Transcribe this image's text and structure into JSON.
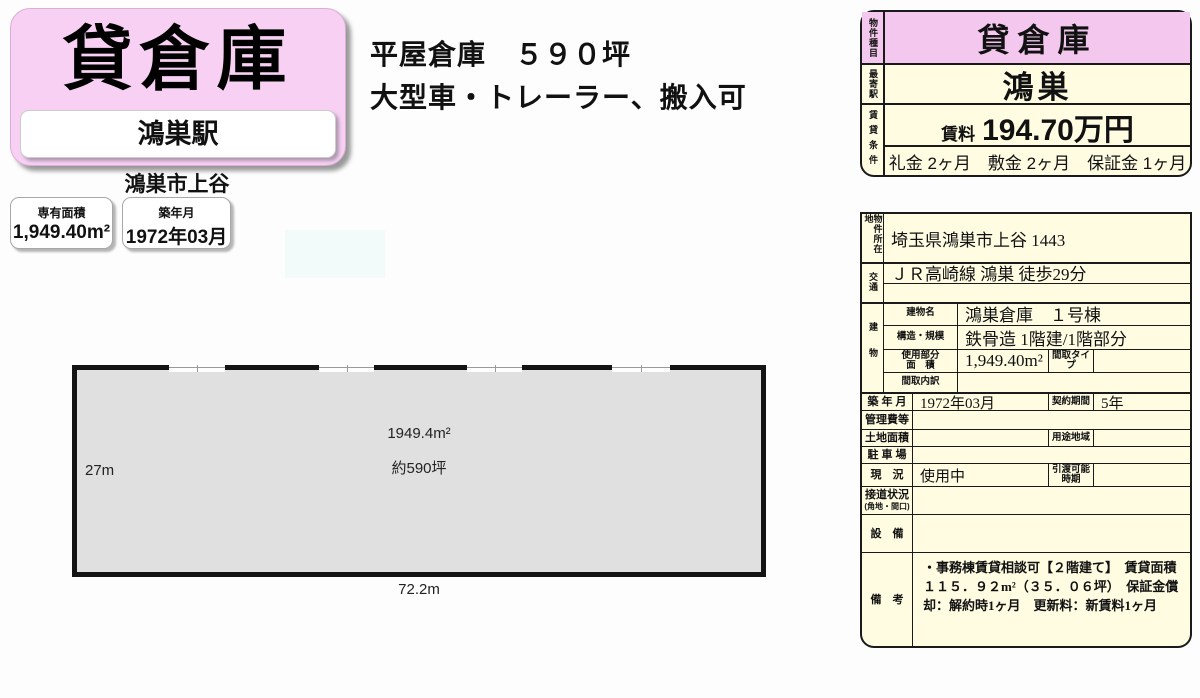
{
  "banner": {
    "title": "貸倉庫",
    "station": "鴻巣駅",
    "city": "鴻巣市上谷",
    "pink": "#f7d0f3"
  },
  "info_boxes": {
    "area": {
      "label": "専有面積",
      "value": "1,949.40m²"
    },
    "built": {
      "label": "築年月",
      "value": "1972年03月"
    }
  },
  "headline": {
    "line1": "平屋倉庫　５９０坪",
    "line2": "大型車・トレーラー、搬入可"
  },
  "floorplan": {
    "height_label": "27m",
    "width_label": "72.2m",
    "area_m2": "1949.4m²",
    "area_tsubo": "約590坪",
    "fill_color": "#e0e0e0"
  },
  "summary_table": {
    "pink": "#f4c8ee",
    "yellow": "#fffce2",
    "type": {
      "label": "物件種目",
      "value": "貸倉庫"
    },
    "station": {
      "label": "最寄駅",
      "value": "鴻巣"
    },
    "terms": {
      "label": "賃貸条件",
      "rent_label": "賃料",
      "rent": "194.70万円",
      "fees": "礼金 2ヶ月　敷金 2ヶ月　保証金 1ヶ月"
    }
  },
  "detail_table": {
    "location": {
      "label": "物件所在地",
      "value": "埼玉県鴻巣市上谷 1443"
    },
    "transport": {
      "label": "交通",
      "line1": "ＪＲ高崎線 鴻巣 徒歩29分",
      "line2": ""
    },
    "building": {
      "label": "建物",
      "name_label": "建物名",
      "name": "鴻巣倉庫　１号棟",
      "structure_label": "構造・規模",
      "structure": "鉄骨造 1階建/1階部分",
      "area_label_line1": "使用部分",
      "area_label_line2": "面　積",
      "area": "1,949.40m²",
      "plan_type_label": "間取タイプ",
      "plan_type": "",
      "plan_detail_label": "間取内訳",
      "plan_detail": ""
    },
    "built": {
      "label": "築 年 月",
      "value": "1972年03月"
    },
    "contract": {
      "label": "契約期間",
      "value": "5年"
    },
    "management_fee": {
      "label": "管理費等",
      "value": ""
    },
    "land_area": {
      "label": "土地面積",
      "value": ""
    },
    "zoning": {
      "label": "用途地域",
      "value": ""
    },
    "parking": {
      "label": "駐 車 場",
      "value": ""
    },
    "status": {
      "label": "現　況",
      "value": "使用中"
    },
    "handover": {
      "label_line1": "引渡可能",
      "label_line2": "時期",
      "value": ""
    },
    "road": {
      "label_line1": "接道状況",
      "label_line2": "(角地・間口)",
      "value": ""
    },
    "equipment": {
      "label": "設　備",
      "value": ""
    },
    "remarks": {
      "label": "備　考",
      "value": "・事務棟賃貸相談可【２階建て】　賃貸面積　１１５．９２m²（３５．０６坪）　保証金償却：解約時1ヶ月　更新料：新賃料1ヶ月"
    }
  }
}
